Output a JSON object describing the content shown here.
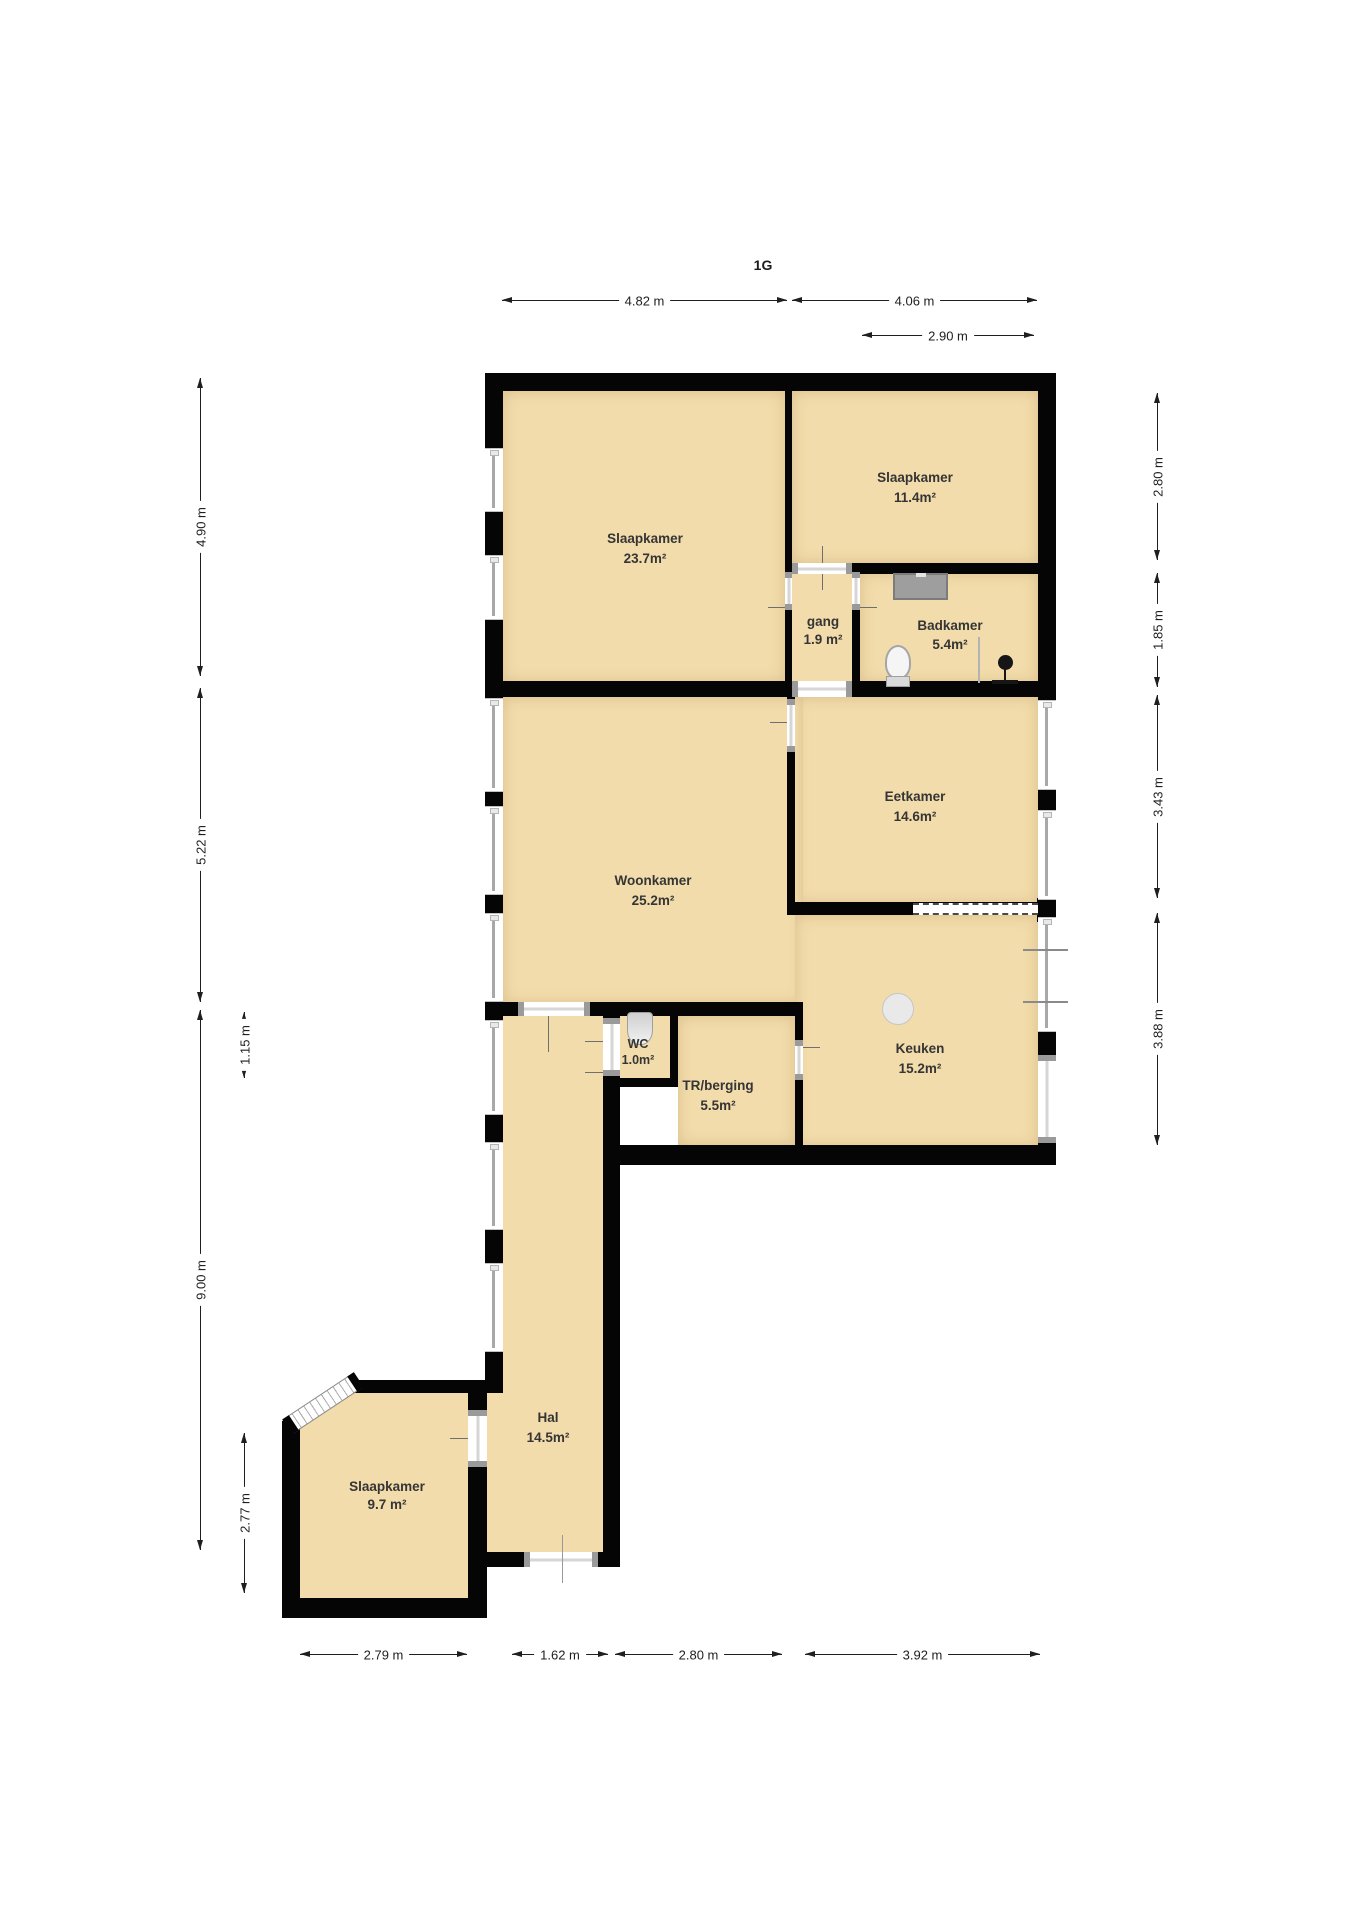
{
  "title": "1G",
  "rooms": [
    {
      "name": "Slaapkamer",
      "area": "23.7m²"
    },
    {
      "name": "Slaapkamer",
      "area": "11.4m²"
    },
    {
      "name": "gang",
      "area": "1.9 m²"
    },
    {
      "name": "Badkamer",
      "area": "5.4m²"
    },
    {
      "name": "Eetkamer",
      "area": "14.6m²"
    },
    {
      "name": "Woonkamer",
      "area": "25.2m²"
    },
    {
      "name": "WC",
      "area": "1.0m²"
    },
    {
      "name": "TR/berging",
      "area": "5.5m²"
    },
    {
      "name": "Keuken",
      "area": "15.2m²"
    },
    {
      "name": "Hal",
      "area": "14.5m²"
    },
    {
      "name": "Slaapkamer",
      "area": "9.7 m²"
    }
  ],
  "dimensions": {
    "top": [
      "4.82 m",
      "4.06 m",
      "2.90 m"
    ],
    "left": [
      "4.90 m",
      "5.22 m",
      "1.15 m",
      "9.00 m",
      "2.77 m"
    ],
    "right": [
      "2.80 m",
      "1.85 m",
      "3.43 m",
      "3.88 m"
    ],
    "bottom": [
      "2.79 m",
      "1.62 m",
      "2.80 m",
      "3.92 m"
    ]
  },
  "fixtures": [
    "washbasin",
    "toilet",
    "shower",
    "wc-toilet",
    "kitchen-circle"
  ],
  "colors": {
    "room_fill": "#f2dcab",
    "wall": "#050505",
    "glass": "#a8a8a8",
    "door_frame": "#9a9a9a",
    "fixture_gray": "#9e9e9e"
  }
}
